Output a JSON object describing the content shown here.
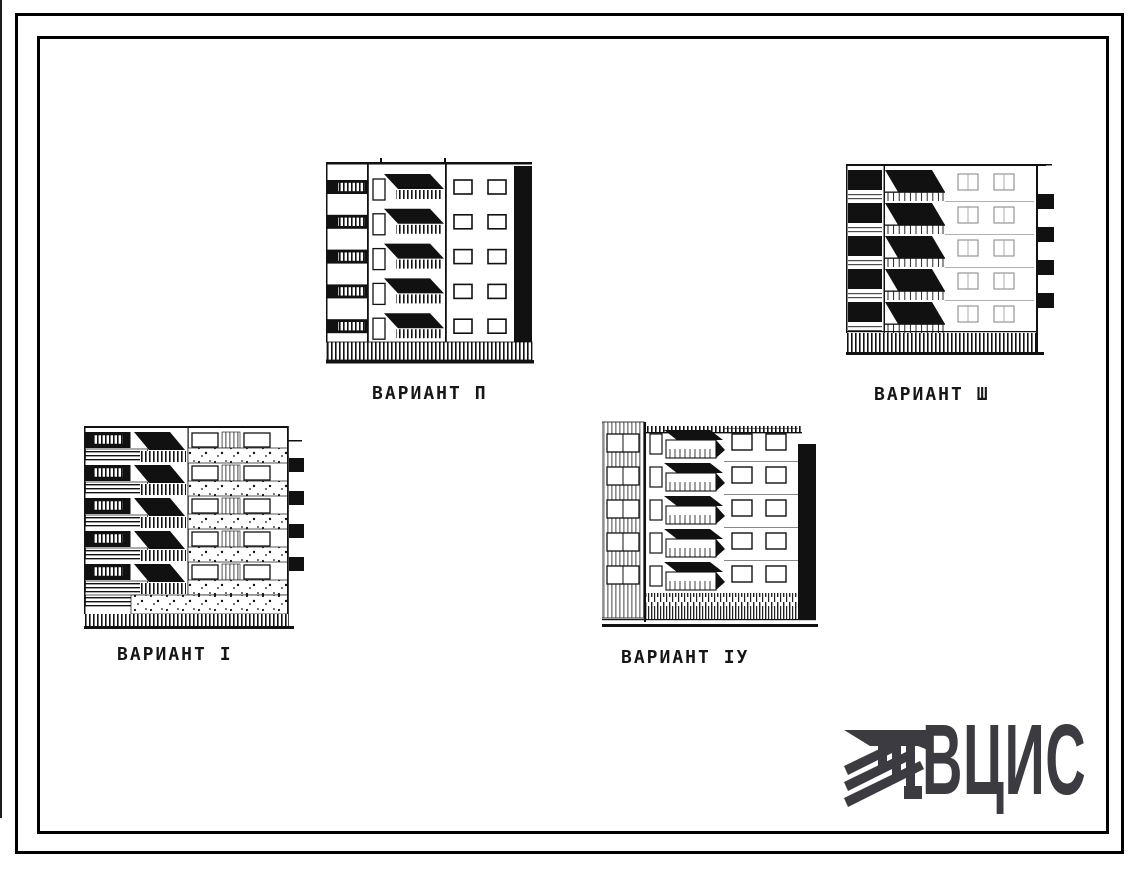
{
  "document": {
    "type": "architectural-facade-variants-sheet",
    "colors": {
      "ink": "#111111",
      "paper": "#ffffff",
      "faint_print": "#8d8d8d",
      "logo": "#3b3b41"
    }
  },
  "figures": [
    {
      "id": "variant-1",
      "label": "ВАРИАНТ I",
      "floors": 5
    },
    {
      "id": "variant-2",
      "label": "ВАРИАНТ П",
      "floors": 5
    },
    {
      "id": "variant-3",
      "label": "ВАРИАНТ Ш",
      "floors": 5
    },
    {
      "id": "variant-4",
      "label": "ВАРИАНТ IУ",
      "floors": 5
    }
  ],
  "logo": {
    "text": "ВЦИС",
    "color": "#3b3b41"
  }
}
